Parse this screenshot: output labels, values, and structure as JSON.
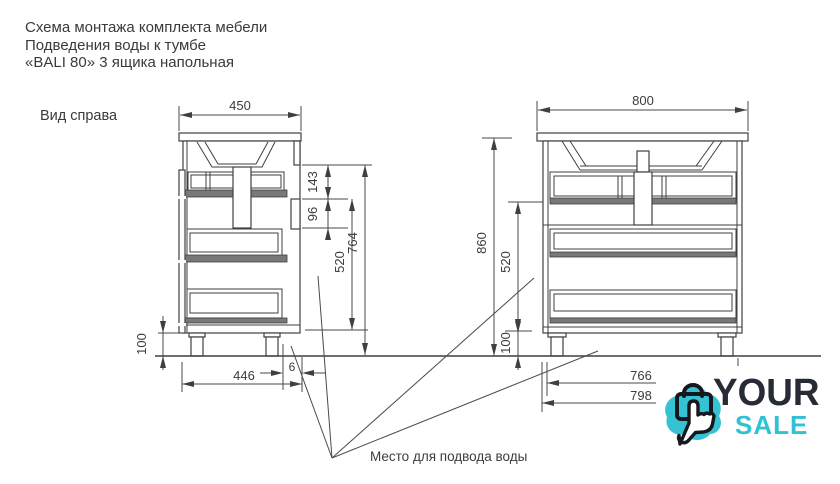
{
  "header": {
    "line1": "Схема монтажа комплекта мебели",
    "line2": "Подведения воды к тумбе",
    "line3": "«BALI 80» 3 ящика напольная"
  },
  "side_view": {
    "label": "Вид справа",
    "dims": {
      "top_width": "450",
      "upper_height": "143",
      "bracket_height": "96",
      "drawer_zone_height": "520",
      "body_height": "764",
      "leg_height": "100",
      "depth": "446",
      "back_gap": "6"
    }
  },
  "front_view": {
    "dims": {
      "top_width": "800",
      "total_height": "860",
      "drawer_zone_height": "520",
      "leg_height": "100",
      "inner_width": "766",
      "outer_width": "798"
    }
  },
  "annotation": {
    "note": "Место для подвода воды"
  },
  "logo": {
    "brand_top": "YOUR",
    "brand_bottom": "SALE",
    "icon": "shopping-bag-hand-cursor-icon",
    "accent_color": "#35c3d4",
    "text_color": "#262b36"
  },
  "colors": {
    "line": "#3f3f3f",
    "dimension": "#4a4a4a",
    "rail_fill": "#787878"
  }
}
